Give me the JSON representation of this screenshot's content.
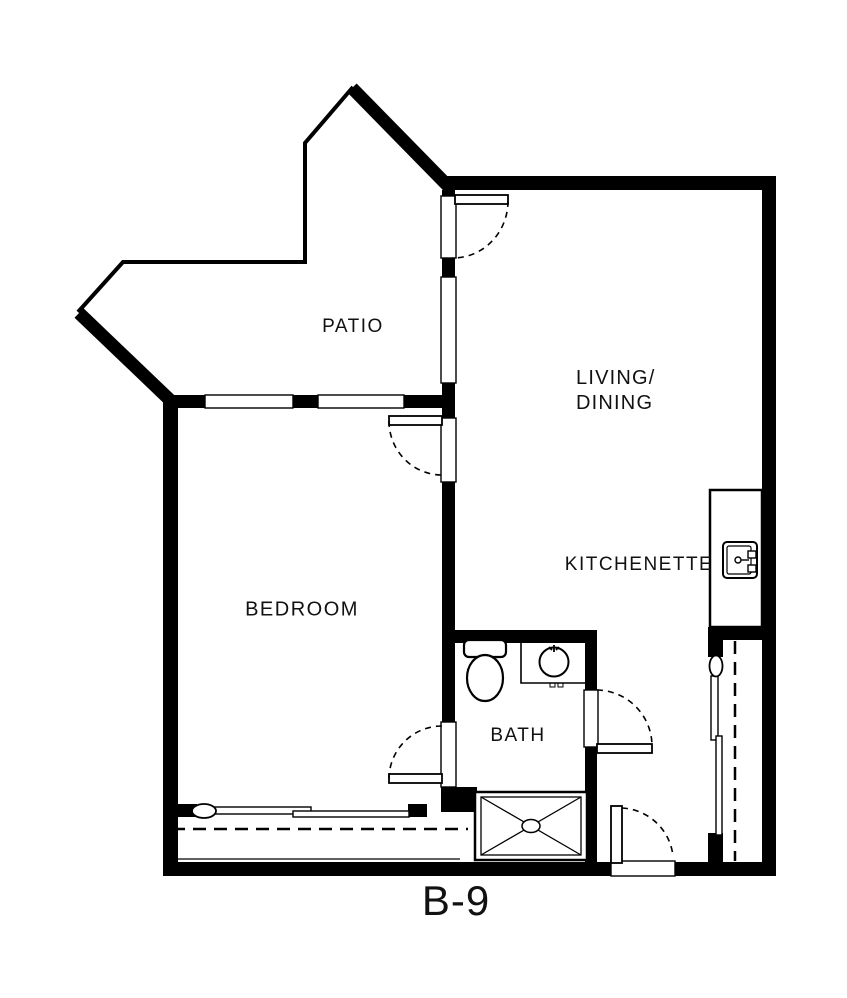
{
  "plan": {
    "unit_label": "B-9",
    "rooms": {
      "patio": {
        "label": "PATIO"
      },
      "living_dining": {
        "label": "LIVING/\nDINING"
      },
      "bedroom": {
        "label": "BEDROOM"
      },
      "kitchenette": {
        "label": "KITCHENETTE"
      },
      "bath": {
        "label": "BATH"
      }
    },
    "fixtures": {
      "icons": [
        "toilet-icon",
        "bath-sink-icon",
        "shower-icon",
        "kitchen-sink-icon",
        "sliding-door-bedroom",
        "sliding-door-side",
        "swing-door-arcs"
      ]
    },
    "colors": {
      "wall": "#000000",
      "background": "#ffffff",
      "text": "#111111"
    }
  }
}
